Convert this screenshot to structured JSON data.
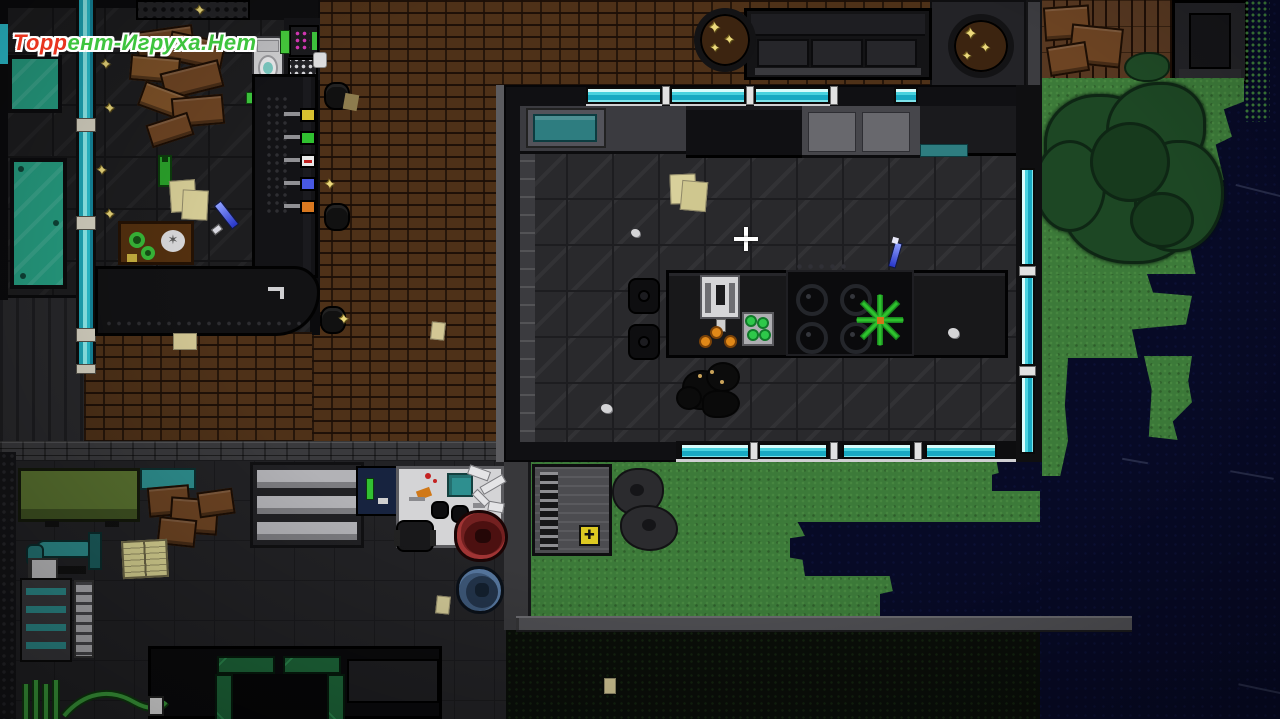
{
  "watermark": {
    "text": "Торрент-Игруха.Нет",
    "part_red": "Торр",
    "part_green": "ент-Игруха.Нет",
    "color_red": "#e8351f",
    "color_green": "#3ec43e",
    "outline": "#ffffff"
  },
  "cursor": {
    "kind": "crosshair",
    "x": 746,
    "y": 239,
    "color": "#ffffff"
  },
  "glyphs": {
    "sparkle": "✦",
    "plate_crack": "✶",
    "hazard": "✚"
  },
  "palette": {
    "brick": "#4e3118",
    "floor_dark": "#1d1d1f",
    "floor_kitchen": "#29292c",
    "window_glass": "#2cc4d4",
    "grass": "#3c7a39",
    "night_shadow": "#070a26",
    "tree": "#1d4724",
    "gold": "#ecd97c",
    "teal_fixture": "#2e8f8f",
    "tub_red": "#732020",
    "tub_blue": "#3c5676",
    "plant_green": "#2ec22e",
    "orange_fruit": "#e08818",
    "wood_brown": "#6d4423",
    "watermark_red": "#e8351f",
    "watermark_green": "#3ec43e"
  },
  "entities": {
    "rooms": [
      "bar-lounge",
      "kitchen",
      "workshop",
      "garage",
      "backyard"
    ],
    "objects": [
      "pool-table",
      "window-wall",
      "bar-counter",
      "beer-taps",
      "cash-register",
      "broken-furniture",
      "toilet",
      "food-tray",
      "knife",
      "kitchen-island",
      "gas-stove",
      "blender",
      "vegetable-crate",
      "oranges",
      "potted-plant",
      "dead-dog",
      "golden-potted-plant",
      "sofa",
      "wooden-deck",
      "cardboard-boxes",
      "tree",
      "lawn",
      "maintenance-hatch",
      "hazard-sign",
      "bushes",
      "metal-shelves",
      "workbench",
      "office-chair",
      "red-tub",
      "blue-tub",
      "green-pipes",
      "scattered-papers",
      "glass-shards",
      "crosshair-cursor"
    ]
  }
}
